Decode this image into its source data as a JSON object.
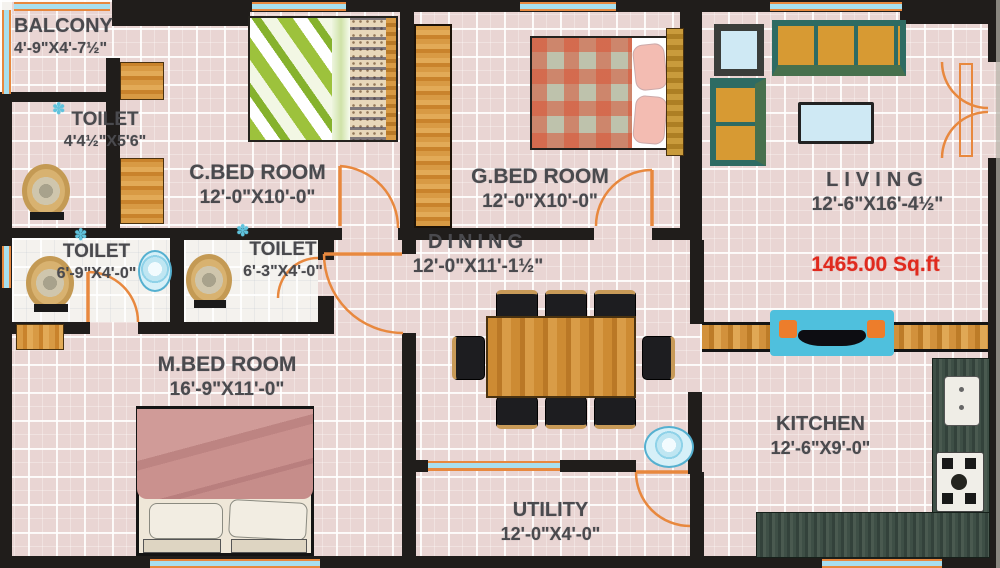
{
  "plan": {
    "area_label": "1465.00 Sq.ft",
    "rooms": {
      "balcony": {
        "name": "BALCONY",
        "dims": "4'-9\"X4'-7½\""
      },
      "toilet_top": {
        "name": "TOILET",
        "dims": "4'4½\"X5'6\""
      },
      "c_bedroom": {
        "name": "C.BED ROOM",
        "dims": "12'-0\"X10'-0\""
      },
      "g_bedroom": {
        "name": "G.BED ROOM",
        "dims": "12'-0\"X10'-0\""
      },
      "living": {
        "name": "LIVING",
        "dims": "12'-6\"X16'-4½\""
      },
      "dining": {
        "name": "DINING",
        "dims": "12'-0\"X11'-1½\""
      },
      "toilet_left": {
        "name": "TOILET",
        "dims": "6'-9\"X4'-0\""
      },
      "toilet_mid": {
        "name": "TOILET",
        "dims": "6'-3\"X4'-0\""
      },
      "m_bedroom": {
        "name": "M.BED ROOM",
        "dims": "16'-9\"X11'-0\""
      },
      "kitchen": {
        "name": "KITCHEN",
        "dims": "12'-6\"X9'-0\""
      },
      "utility": {
        "name": "UTILITY",
        "dims": "12'-0\"X4'-0\""
      }
    },
    "colors": {
      "wall": "#201d1b",
      "floor_tile": "#e9d5d3",
      "wood": "#d2913c",
      "window_teal": "#a8dfee",
      "door_orange": "#e8883e",
      "area_red": "#e02a1e"
    }
  }
}
